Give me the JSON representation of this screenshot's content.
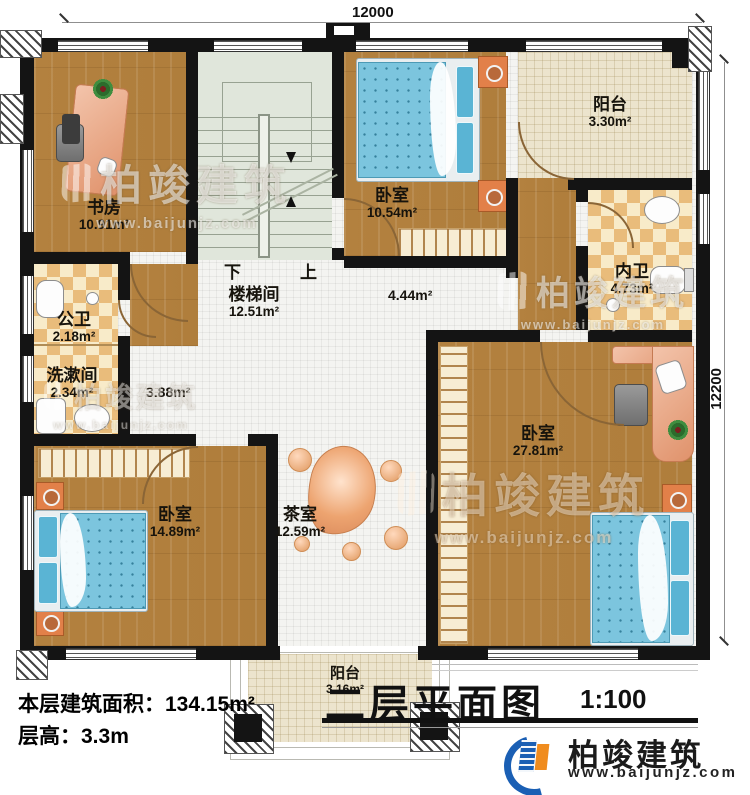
{
  "dimensions": {
    "top": "12000",
    "right": "12200"
  },
  "rooms": {
    "study": {
      "name": "书房",
      "area": "10.91m²"
    },
    "stairwell": {
      "name": "楼梯间",
      "area": "12.51m²"
    },
    "bedroom_top": {
      "name": "卧室",
      "area": "10.54m²"
    },
    "balcony_top": {
      "name": "阳台",
      "area": "3.30m²"
    },
    "inner_bath": {
      "name": "内卫",
      "area": "4.73m²"
    },
    "public_bath": {
      "name": "公卫",
      "area": "2.18m²"
    },
    "washroom": {
      "name": "洗漱间",
      "area": "2.34m²"
    },
    "hall_small": {
      "area": "3.88m²"
    },
    "hall_mid": {
      "area": "4.44m²"
    },
    "bedroom_left": {
      "name": "卧室",
      "area": "14.89m²"
    },
    "tea_room": {
      "name": "茶室",
      "area": "12.59m²"
    },
    "bedroom_big": {
      "name": "卧室",
      "area": "27.81m²"
    },
    "balcony_bottom": {
      "name": "阳台",
      "area": "3.16m²"
    }
  },
  "stairs": {
    "down": "下",
    "up": "上"
  },
  "footer": {
    "floor_area": "本层建筑面积：134.15m²",
    "floor_height": "层高：3.3m"
  },
  "title": {
    "text": "二层平面图",
    "scale": "1:100"
  },
  "brand": {
    "name": "柏竣建筑",
    "url": "www.baijunjz.com"
  },
  "watermark": {
    "name": "柏竣建筑",
    "url": "www.baijunjz.com"
  }
}
